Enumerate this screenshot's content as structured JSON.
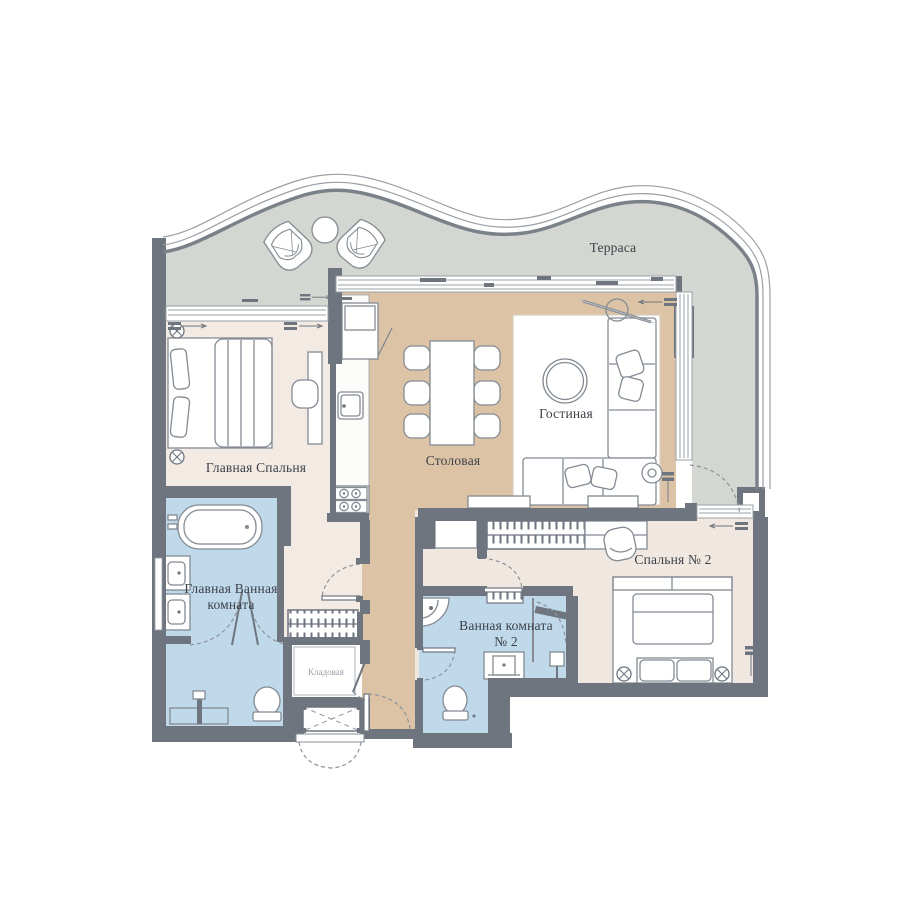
{
  "floor_plan": {
    "labels": {
      "terrace": "Терраса",
      "master_bedroom": "Главная Спальня",
      "dining": "Столовая",
      "living": "Гостиная",
      "bedroom2": "Спальня № 2",
      "bathroom2_line1": "Ванная комната",
      "bathroom2_line2": "№ 2",
      "master_bath_line1": "Главная Ванная",
      "master_bath_line2": "комната",
      "storage": "Кладовая"
    },
    "colors": {
      "wall": "#6e757e",
      "terrace_floor": "#d4d6d1",
      "wood_floor": "#dcc3a6",
      "master_bedroom_floor": "#f2eae3",
      "bedroom2_floor": "#f0e7e0",
      "bathroom_floor": "#bfd8ea",
      "rug": "#ffffff",
      "label_text": "#3c4148"
    }
  }
}
